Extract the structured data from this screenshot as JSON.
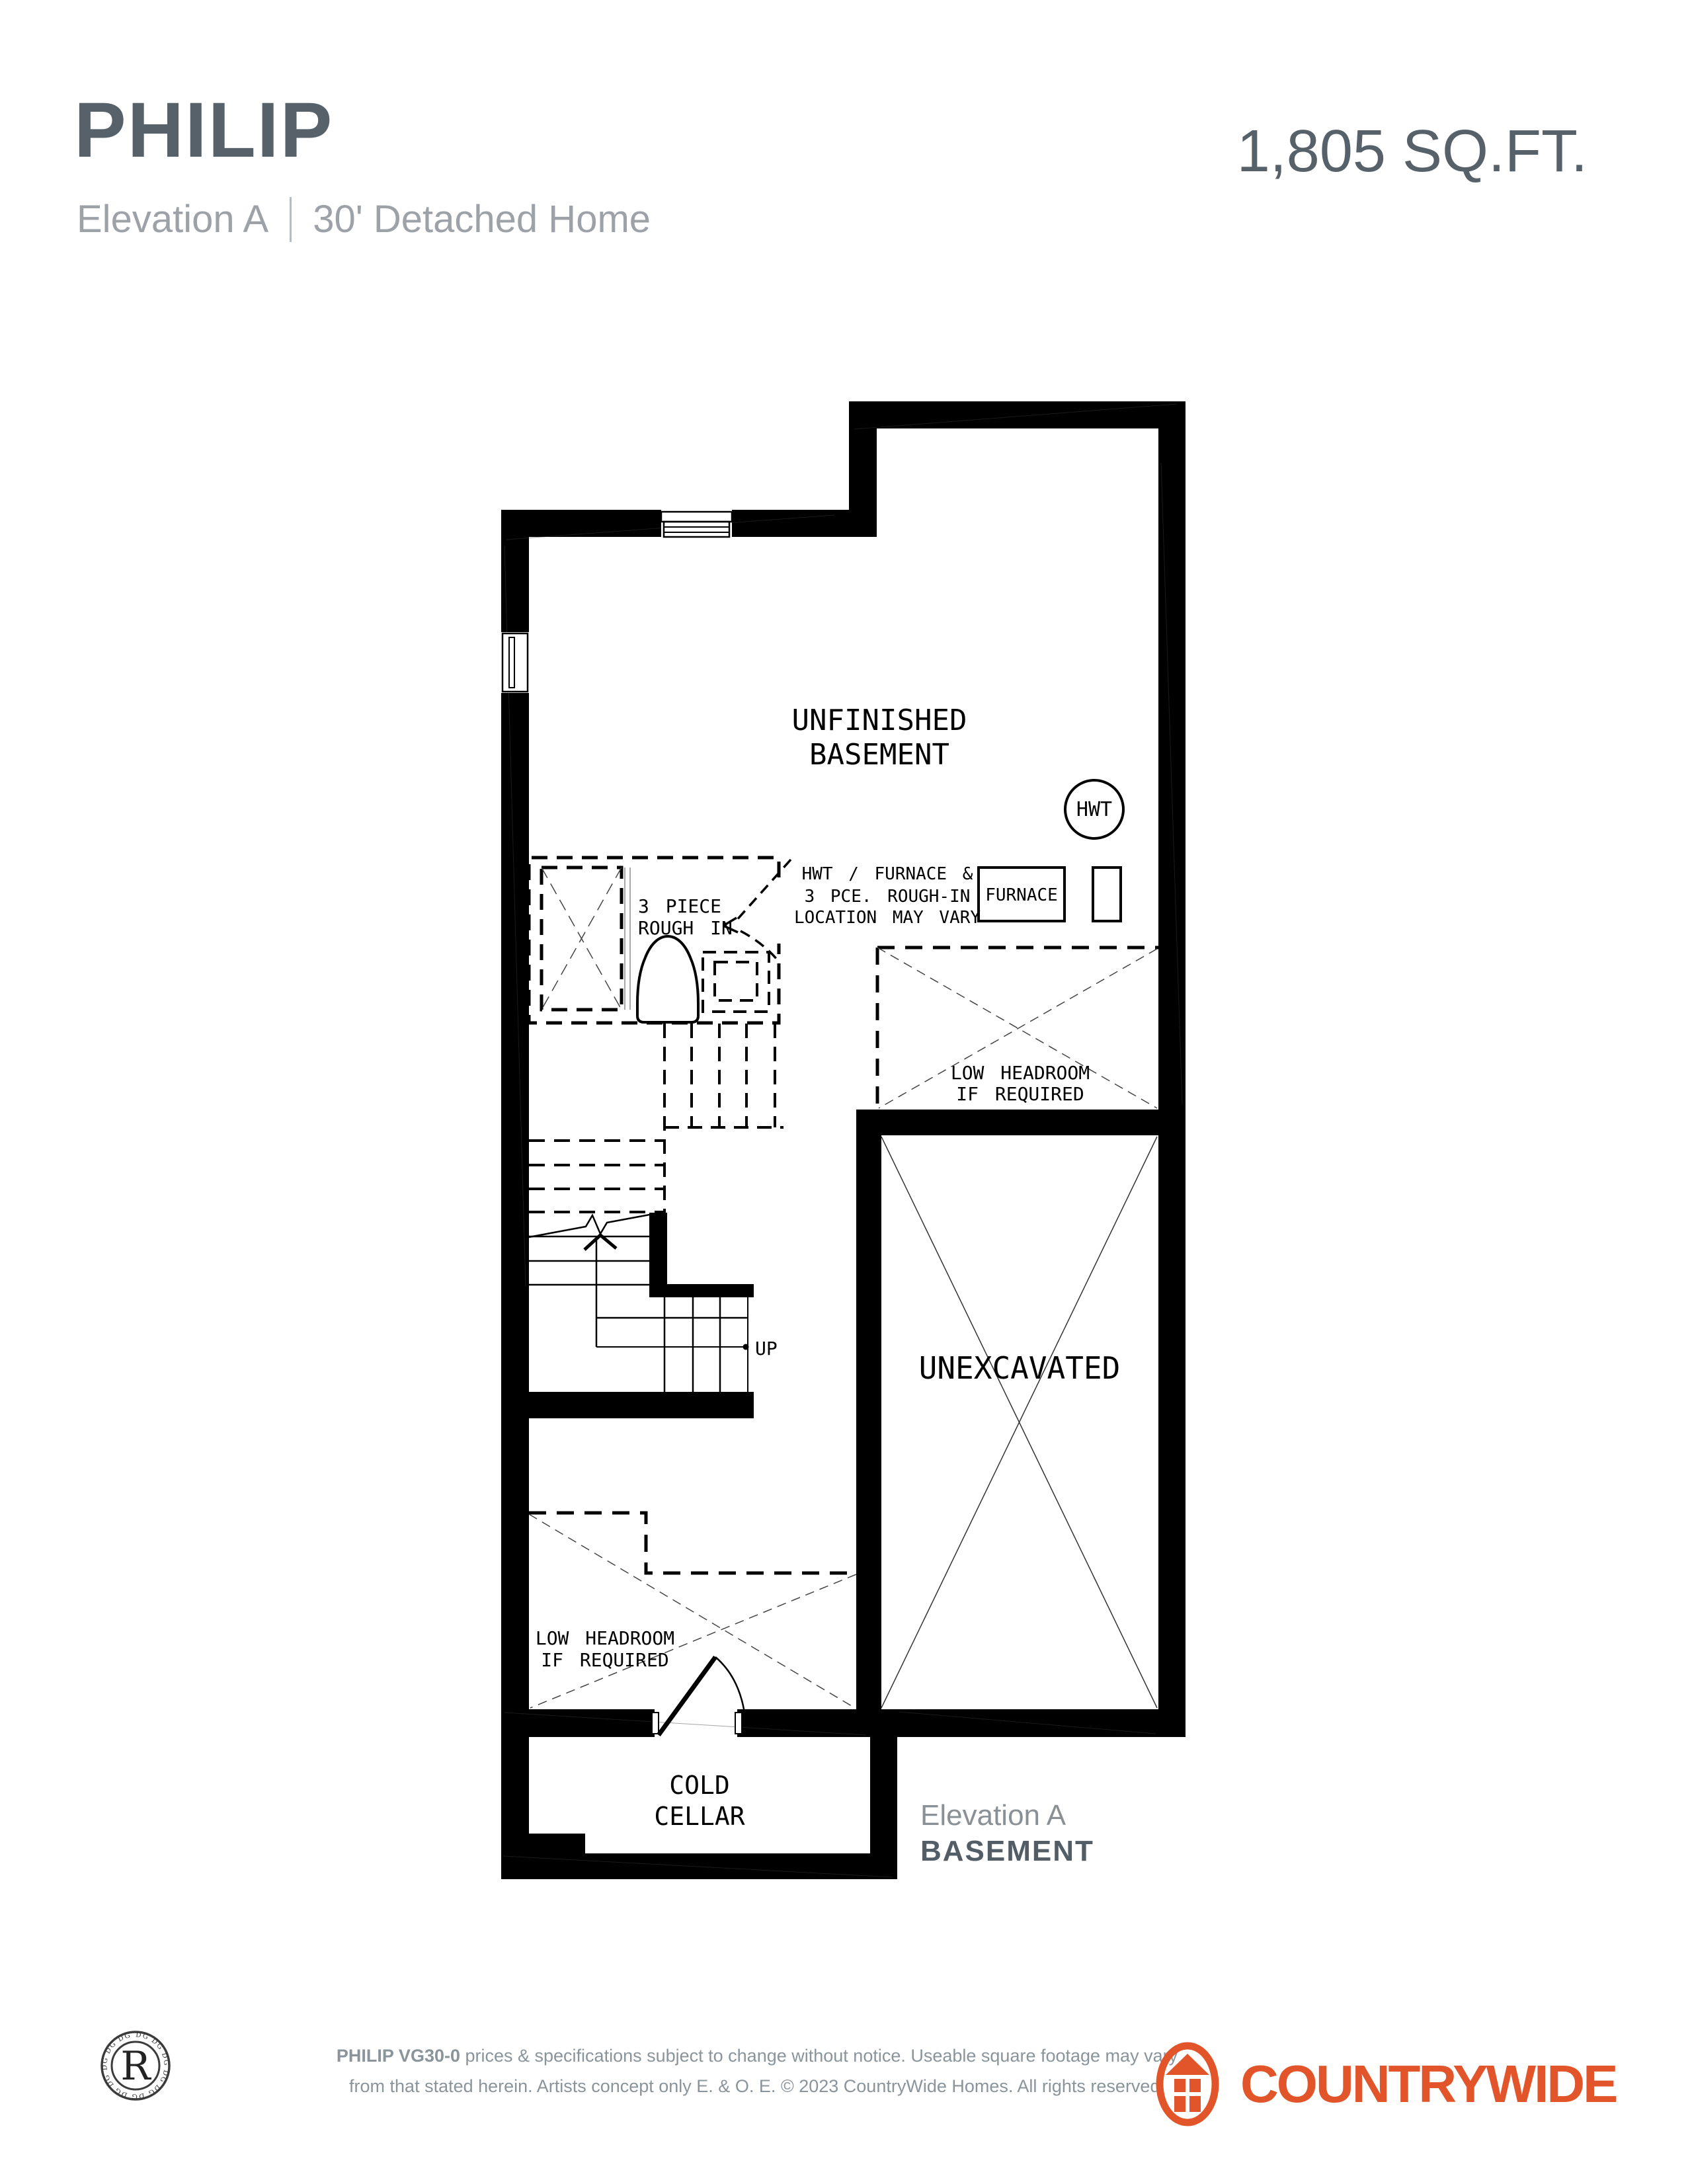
{
  "header": {
    "title": "PHILIP",
    "area": "1,805 SQ.FT.",
    "subtitle_elevation": "Elevation A",
    "subtitle_home": "30' Detached Home"
  },
  "plan": {
    "labels": {
      "unfinished1": "UNFINISHED",
      "unfinished2": "BASEMENT",
      "hwt": "HWT",
      "note1": "HWT / FURNACE &",
      "note2": "3 PCE. ROUGH-IN",
      "note3": "LOCATION MAY VARY",
      "furnace": "FURNACE",
      "roughin1": "3 PIECE",
      "roughin2": "ROUGH IN",
      "lowheadroom1": "LOW HEADROOM",
      "lowheadroom2": "IF REQUIRED",
      "unexcavated": "UNEXCAVATED",
      "up": "UP",
      "coldcellar1": "COLD",
      "coldcellar2": "CELLAR"
    },
    "caption": {
      "line1": "Elevation A",
      "line2": "BASEMENT"
    }
  },
  "footer": {
    "badge_letter": "R",
    "badge_ring": "DG DG DG DG DG DG DG DG DG DG DG DG DG DG",
    "disclaimer_bold": "PHILIP VG30-0",
    "disclaimer_line1": " prices & specifications subject to change without notice. Useable square footage may vary",
    "disclaimer_line2": "from that stated herein. Artists concept only E. & O. E. © 2023 CountryWide Homes. All rights reserved.",
    "brand_word1": "COUNTRY",
    "brand_word2": "WIDE"
  },
  "colors": {
    "brand_orange": "#E2552B",
    "title_gray": "#57616A",
    "subtitle_gray": "#9CA2A7",
    "footer_gray": "#8A949B",
    "plan_ink": "#000000"
  }
}
